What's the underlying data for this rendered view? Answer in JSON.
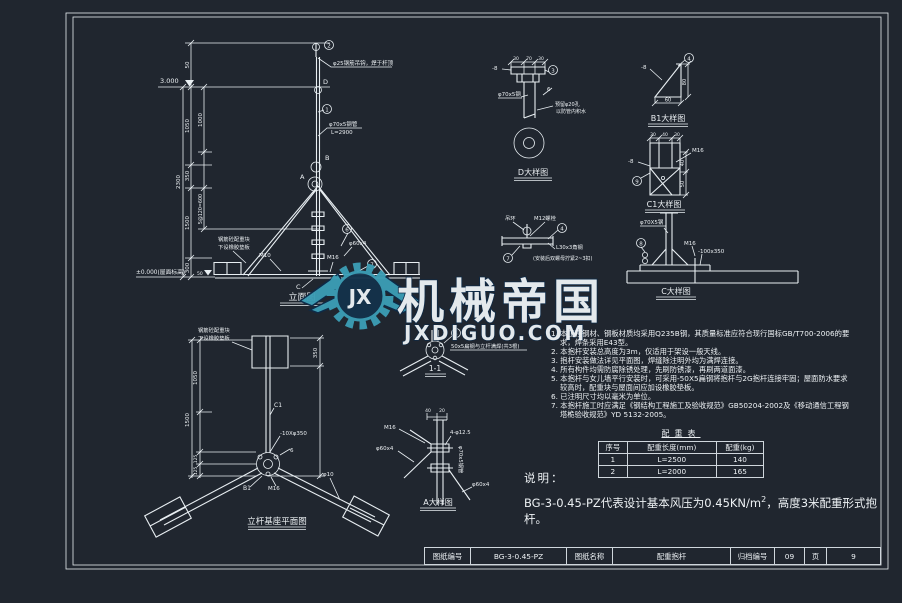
{
  "watermark": {
    "brand": "机械帝国",
    "site": "JXDIGUO.COM",
    "logo": "JX"
  },
  "titleblock": {
    "l1": "图纸编号",
    "v1": "BG-3-0.45-PZ",
    "l2": "图纸名称",
    "v2": "配重抱杆",
    "l3": "归档编号",
    "v3": "09",
    "l4": "页",
    "v4": "9"
  },
  "legend": {
    "caption": "说明：",
    "t1": "BG-3-0.45-PZ代表设计基本风压为0.45KN/m",
    "sup": "2",
    "t2": "，高度3米配重形式抱杆。"
  },
  "notes": [
    "1. 本工程钢材、钢板材质均采用Q235B钢，其质量标准应符合现行国标GB/T700-2006的要求，焊条采用E43型。",
    "2. 本抱杆安装总高度为3m，仅适用于架设一般天线。",
    "3. 抱杆安装做法详见平面图，焊缝除注明外均为满焊连接。",
    "4. 所有构件均需防腐除锈处理，先刷防锈漆，再刷两道面漆。",
    "5. 本抱杆与女儿墙平行安装时，可采用-50X5扁钢将抱杆与2G抱杆连接牢固；屋面防水要求较高时，配重块与屋面间应加设橡胶垫板。",
    "6. 已注明尺寸均以毫米为单位。",
    "7. 本抱杆施工时应满足《钢结构工程施工及验收规范》GB50204-2002及《移动通信工程钢塔桅验收规范》YD 5132-2005。"
  ],
  "table": {
    "title": "配重表",
    "h": [
      "序号",
      "配重长度(mm)",
      "配重(kg)"
    ],
    "rows": [
      [
        "1",
        "L=2500",
        "140"
      ],
      [
        "2",
        "L=2000",
        "165"
      ]
    ]
  },
  "elev": {
    "title": "立面图",
    "lvl": "3.000",
    "zero": "±0.000(屋面标高)",
    "d50": "50",
    "d1000": "1000",
    "d1050": "1050",
    "d2300": "2300",
    "d350": "350",
    "d600": "5@120=600",
    "d1500": "1500",
    "d300": "300",
    "d50b": "50",
    "hook": "φ25钢筋吊钩，焊于杆顶",
    "pipe": "φ70x5钢管",
    "pipeL": "L=2900",
    "jA": "A",
    "jB": "B",
    "jD": "D",
    "jC": "C",
    "c1": "1",
    "c2": "2",
    "c6": "6",
    "c7": "7",
    "m10": "M10",
    "m16": "M16",
    "p60": "φ60x4",
    "note1": "钢筋砼配重块",
    "note2": "下设橡胶垫板"
  },
  "plan": {
    "title": "立杆基座平面图",
    "note1": "钢筋砼配重块",
    "note2": "下设橡胶垫板",
    "d350": "350",
    "d1050": "1050",
    "d1500": "1500",
    "d125a": "125",
    "d125b": "125",
    "c1": "C1",
    "plate": "-10Xφ350",
    "w6": "6",
    "b1": "B1",
    "m16": "M16",
    "p10": "φ10"
  },
  "sec": {
    "title": "1-1",
    "c5": "5",
    "label": "50x5扁钢与立杆满焊(共3根)"
  },
  "dA": {
    "title": "A大样图",
    "m16": "M16",
    "p60a": "φ60x4",
    "p60b": "φ60x4",
    "pipe": "φ70x5钢管",
    "hole": "4-φ12.5",
    "d40": "40",
    "d20": "20"
  },
  "dD": {
    "title": "D大样图",
    "d30a": "30",
    "d70": "70",
    "d30b": "30",
    "p8": "-8",
    "c3": "3",
    "w6": "6",
    "pipe": "φ70x5钢",
    "note1": "预留φ20孔",
    "note2": "以防管内积水"
  },
  "dHook": {
    "lug": "吊环",
    "m12": "M12螺栓",
    "c4": "4",
    "angle": "L30x3角钢",
    "note": "(安装后双螺母拧紧2~3扣)",
    "c7": "7"
  },
  "dB1": {
    "title": "B1大样图",
    "p8": "-8",
    "c4": "4",
    "d60": "60",
    "d80": "80"
  },
  "dC1": {
    "title": "C1大样图",
    "d30a": "30",
    "d40": "40",
    "d30b": "30",
    "m16": "M16",
    "p8": "-8",
    "c9": "9",
    "dr40": "40",
    "dr50": "50"
  },
  "dC": {
    "title": "C大样图",
    "pipe": "φ70X5钢",
    "m16": "M16",
    "plate": "-100x350",
    "c8": "8"
  },
  "colors": {
    "bg": "#20262f",
    "line": "#e8eef2",
    "watermark": "#3c9db5",
    "watermark_dark": "#0d2b49"
  }
}
